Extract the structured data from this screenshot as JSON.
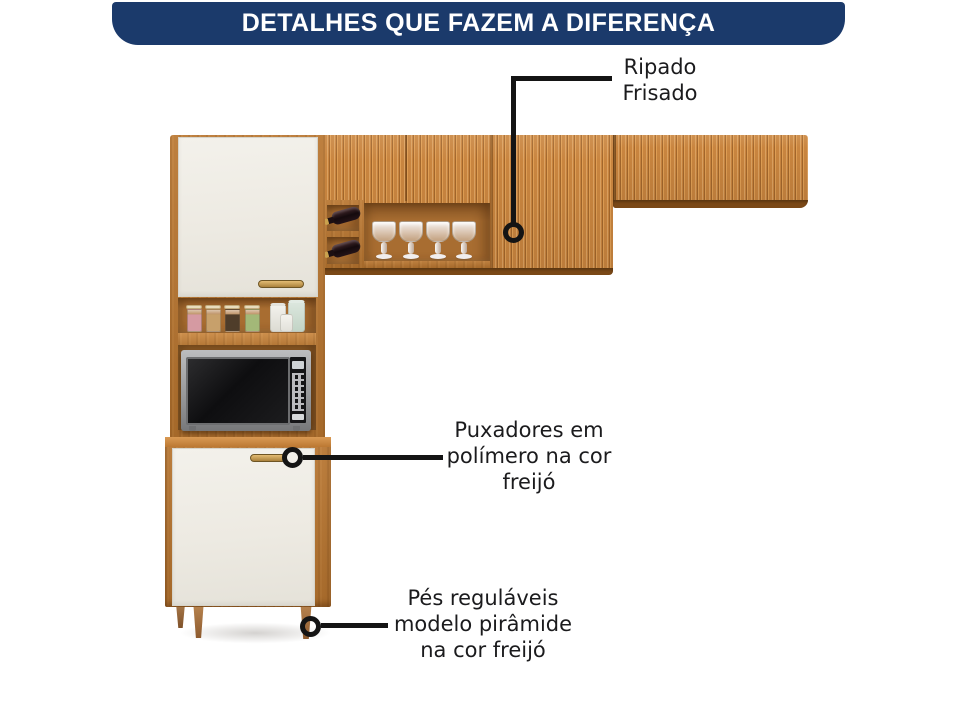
{
  "banner": {
    "title": "DETALHES QUE FAZEM A DIFERENÇA"
  },
  "callouts": {
    "ripado_frisado": {
      "lines": [
        "Ripado",
        "Frisado"
      ]
    },
    "puxadores": {
      "lines": [
        "Puxadores em",
        "polímero na cor",
        "freijó"
      ]
    },
    "pes": {
      "lines": [
        "Pés reguláveis",
        "modelo pirâmide",
        "na cor freijó"
      ]
    }
  },
  "icons": {
    "callout_marker": "open-ring"
  },
  "colors": {
    "banner_bg": "#1b3a6b",
    "banner_text": "#ffffff",
    "callout_text": "#1b1b1d",
    "callout_line": "#141414",
    "wood_freijo": "#c9853f",
    "wood_dark_edge": "#7a4817",
    "door_offwhite": "#f1eee7",
    "handle_gold": "#c79a4e"
  }
}
